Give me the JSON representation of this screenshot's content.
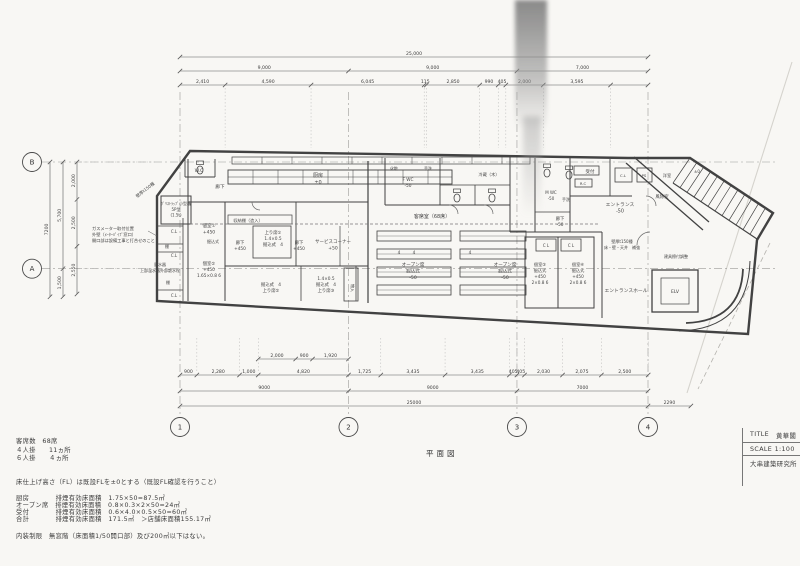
{
  "sheet": {
    "caption": "平面図"
  },
  "title_block": {
    "title_label": "TITLE",
    "title_value": "黄華閣",
    "scale": "SCALE 1:100",
    "firm": "大串建築研究所"
  },
  "notes": {
    "seats": "客席数　68席",
    "four_top": "４人掛　　11ヵ所",
    "six_top": "６人掛　　４ヵ所",
    "fl_note": "床仕上げ高さ（FL）は既設FLを±0とする（既設FL確認を行うこと）",
    "smoke_kitchen": "厨房　　　　排煙有効床面積　1.75×50=87.5㎡",
    "smoke_open": "オープン席　排煙有効床面積　0.8×0.3×2×50=24㎡",
    "smoke_reception": "受付　　　　排煙有効床面積　0.6×4.0×0.5×50=60㎡",
    "smoke_total": "合計　　　　排煙有効床面積　171.5㎡　＞店舗床面積155.17㎡",
    "interior_limit": "内装制限　無窓階（床面積1/50開口部）及び200㎡以下はない。"
  },
  "grid": {
    "bottom": [
      {
        "label": "1",
        "mm": 0
      },
      {
        "label": "2",
        "mm": 9000
      },
      {
        "label": "3",
        "mm": 18000
      },
      {
        "label": "4",
        "mm": 25000
      }
    ],
    "left": [
      {
        "label": "B",
        "mm": 0
      },
      {
        "label": "A",
        "mm": 5700
      }
    ]
  },
  "dimensions": {
    "top_rows": [
      {
        "y": 57,
        "full": true,
        "segs": [
          {
            "label": "25,000",
            "mm": 25000
          }
        ]
      },
      {
        "y": 71,
        "full": true,
        "segs": [
          {
            "label": "9,000",
            "mm": 9000
          },
          {
            "label": "9,000",
            "mm": 9000
          },
          {
            "label": "7,000",
            "mm": 7000
          }
        ]
      },
      {
        "y": 85,
        "full": true,
        "segs": [
          {
            "label": "2,410",
            "mm": 2410
          },
          {
            "label": "4,590",
            "mm": 4590
          },
          {
            "label": "6,045",
            "mm": 6045
          },
          {
            "label": "115",
            "mm": 115
          },
          {
            "label": "2,850",
            "mm": 2850
          },
          {
            "label": "990",
            "mm": 990
          },
          {
            "label": "405",
            "mm": 405
          },
          {
            "label": "2,000",
            "mm": 2000
          },
          {
            "label": "3,595",
            "mm": 3595
          }
        ]
      }
    ],
    "bottom_rows": [
      {
        "y": 359,
        "offset_mm": 4180,
        "segs": [
          {
            "label": "2,000",
            "mm": 2000
          },
          {
            "label": "900",
            "mm": 900
          },
          {
            "label": "1,920",
            "mm": 1920
          }
        ]
      },
      {
        "y": 375,
        "full": true,
        "segs": [
          {
            "label": "900",
            "mm": 900
          },
          {
            "label": "2,280",
            "mm": 2280
          },
          {
            "label": "1,000",
            "mm": 1000
          },
          {
            "label": "4,820",
            "mm": 4820
          },
          {
            "label": "1,725",
            "mm": 1725
          },
          {
            "label": "3,435",
            "mm": 3435
          },
          {
            "label": "3,435",
            "mm": 3435
          },
          {
            "label": "405",
            "mm": 405
          },
          {
            "label": "405",
            "mm": 405
          },
          {
            "label": "2,030",
            "mm": 2030
          },
          {
            "label": "2,075",
            "mm": 2075
          },
          {
            "label": "2,500",
            "mm": 2500
          }
        ]
      },
      {
        "y": 391,
        "full": true,
        "segs": [
          {
            "label": "9000",
            "mm": 9000
          },
          {
            "label": "9000",
            "mm": 9000
          },
          {
            "label": "7000",
            "mm": 7000
          }
        ]
      },
      {
        "y": 406,
        "full": true,
        "segs": [
          {
            "label": "25000",
            "mm": 25000
          }
        ],
        "ext": {
          "label": "2290",
          "mm": 2290
        }
      }
    ],
    "left_rows": [
      {
        "x": 77,
        "segs": [
          {
            "label": "2,000",
            "mm": 2000
          },
          {
            "label": "2,500",
            "mm": 2500
          },
          {
            "label": "2,550",
            "mm": 2550
          }
        ]
      },
      {
        "x": 63,
        "segs": [
          {
            "label": "5,700",
            "mm": 5700
          },
          {
            "label": "1,500",
            "mm": 1500
          }
        ]
      },
      {
        "x": 50,
        "segs": [
          {
            "label": "7200",
            "mm": 7200
          }
        ]
      }
    ]
  },
  "plan": {
    "labels": [
      {
        "id": "wc",
        "x": 199,
        "y": 172,
        "fs": 4.6,
        "lines": [
          "W.C"
        ]
      },
      {
        "id": "wall-note-tl",
        "x": 146,
        "y": 191,
        "fs": 4.2,
        "rot": -38,
        "lines": [
          "壁厚t150種"
        ]
      },
      {
        "id": "grease-trap",
        "x": 176,
        "y": 205,
        "fs": 4.0,
        "lines": [
          "ｸﾞﾘｽﾄﾗｯﾌﾟ小型槽",
          "5P型",
          "(1.5t)"
        ]
      },
      {
        "id": "corridor-top",
        "x": 220,
        "y": 188,
        "fs": 4.6,
        "lines": [
          "廊下"
        ]
      },
      {
        "id": "gas-note",
        "x": 92,
        "y": 230,
        "fs": 4.2,
        "anchor": "start",
        "lines": [
          "ガスメーター取付位置",
          "外壁（ﾒｰﾀｰﾊﾟｲﾌﾟ窓口）",
          "開口部は設備工事と打合せのこと"
        ]
      },
      {
        "id": "water-meter",
        "x": 160,
        "y": 266,
        "fs": 4.0,
        "lines": [
          "量水器",
          "上部温水器外部散水栓"
        ]
      },
      {
        "id": "closet-cl-1",
        "x": 174,
        "y": 233,
        "fs": 4.0,
        "lines": [
          "C.L"
        ]
      },
      {
        "id": "closet-tana-1",
        "x": 167,
        "y": 248,
        "fs": 4.0,
        "lines": [
          "棚"
        ]
      },
      {
        "id": "closet-cl-2",
        "x": 174,
        "y": 257,
        "fs": 4.0,
        "lines": [
          "C.L"
        ]
      },
      {
        "id": "closet-tana-2",
        "x": 168,
        "y": 284,
        "fs": 4.0,
        "lines": [
          "棚"
        ]
      },
      {
        "id": "closet-cl-3",
        "x": 174,
        "y": 297,
        "fs": 4.0,
        "lines": [
          "C.L"
        ]
      },
      {
        "id": "kitchen",
        "x": 318,
        "y": 177,
        "fs": 5.0,
        "lines": [
          "厨房",
          "±0"
        ]
      },
      {
        "id": "room-1",
        "x": 209,
        "y": 227,
        "fs": 4.5,
        "lines": [
          "個室①",
          "+450"
        ]
      },
      {
        "id": "room-1-note",
        "x": 213,
        "y": 243,
        "fs": 4.0,
        "lines": [
          "掘込式"
        ]
      },
      {
        "id": "room-2",
        "x": 209,
        "y": 265,
        "fs": 4.3,
        "lines": [
          "個室②",
          "+450",
          "1.65×0.8 6"
        ]
      },
      {
        "id": "storage-shelf",
        "x": 248,
        "y": 222,
        "fs": 4.2,
        "lines": [
          "収納棚（造入）"
        ]
      },
      {
        "id": "corridor-mid-1",
        "x": 240,
        "y": 244,
        "fs": 4.3,
        "lines": [
          "廊下",
          "+450"
        ]
      },
      {
        "id": "agari-1",
        "x": 273,
        "y": 234,
        "fs": 4.3,
        "lines": [
          "上り席①",
          "1.4×0.5",
          "掘込式　4"
        ]
      },
      {
        "id": "corridor-mid-2",
        "x": 299,
        "y": 244,
        "fs": 4.3,
        "lines": [
          "廊下",
          "+450"
        ]
      },
      {
        "id": "service-corner",
        "x": 333,
        "y": 243,
        "fs": 4.5,
        "lines": [
          "サービスコーナー",
          "+50"
        ]
      },
      {
        "id": "agari-2",
        "x": 271,
        "y": 286,
        "fs": 4.3,
        "lines": [
          "掘込式　4",
          "上り席②"
        ]
      },
      {
        "id": "agari-3",
        "x": 326,
        "y": 280,
        "fs": 4.3,
        "lines": [
          "1.4×0.5",
          "掘込式　4",
          "上り席③"
        ]
      },
      {
        "id": "mono-ire",
        "x": 351,
        "y": 288,
        "fs": 4.0,
        "rot": 90,
        "lines": [
          "物入"
        ]
      },
      {
        "id": "guest-seats",
        "x": 432,
        "y": 218,
        "fs": 5.0,
        "lines": [
          "客席室（68席）"
        ]
      },
      {
        "id": "kesho",
        "x": 394,
        "y": 170,
        "fs": 4.0,
        "lines": [
          "化粧"
        ]
      },
      {
        "id": "tearai-1",
        "x": 428,
        "y": 170,
        "fs": 4.0,
        "lines": [
          "手洗"
        ]
      },
      {
        "id": "fwc",
        "x": 408,
        "y": 181,
        "fs": 4.3,
        "lines": [
          "F WC",
          "-50"
        ]
      },
      {
        "id": "reizo",
        "x": 489,
        "y": 176,
        "fs": 4.2,
        "lines": [
          "冷蔵（木）"
        ]
      },
      {
        "id": "mwc",
        "x": 551,
        "y": 194,
        "fs": 4.0,
        "lines": [
          "M WC",
          "-50"
        ]
      },
      {
        "id": "tearai-2",
        "x": 566,
        "y": 201,
        "fs": 4.0,
        "lines": [
          "手洗"
        ]
      },
      {
        "id": "corridor-right",
        "x": 560,
        "y": 220,
        "fs": 4.3,
        "lines": [
          "廊下",
          "-50"
        ]
      },
      {
        "id": "cl-4",
        "x": 546,
        "y": 247,
        "fs": 4.0,
        "lines": [
          "C L"
        ]
      },
      {
        "id": "cl-5",
        "x": 571,
        "y": 247,
        "fs": 4.0,
        "lines": [
          "C L"
        ]
      },
      {
        "id": "room-3",
        "x": 540,
        "y": 266,
        "fs": 4.2,
        "lines": [
          "個室③",
          "掘込式",
          "+450",
          "2×0.8 6"
        ]
      },
      {
        "id": "room-4",
        "x": 578,
        "y": 266,
        "fs": 4.2,
        "lines": [
          "個室④",
          "掘込式",
          "+450",
          "2×0.8 6"
        ]
      },
      {
        "id": "open-1",
        "x": 413,
        "y": 266,
        "fs": 4.6,
        "lines": [
          "オープン席",
          "掘込式",
          "-50"
        ]
      },
      {
        "id": "open-2",
        "x": 505,
        "y": 266,
        "fs": 4.6,
        "lines": [
          "オープン席",
          "掘込式",
          "-50"
        ]
      },
      {
        "id": "seat-count-1",
        "x": 399,
        "y": 254,
        "fs": 4.2,
        "lines": [
          "4"
        ]
      },
      {
        "id": "seat-count-2",
        "x": 414,
        "y": 254,
        "fs": 4.2,
        "lines": [
          "4"
        ]
      },
      {
        "id": "seat-count-3",
        "x": 470,
        "y": 254,
        "fs": 4.2,
        "lines": [
          "4"
        ]
      },
      {
        "id": "entrance",
        "x": 620,
        "y": 206,
        "fs": 4.8,
        "lines": [
          "エントランス",
          "-50"
        ]
      },
      {
        "id": "reception",
        "x": 590,
        "y": 173,
        "fs": 4.5,
        "lines": [
          "受付"
        ]
      },
      {
        "id": "rc",
        "x": 583,
        "y": 185,
        "fs": 3.8,
        "lines": [
          "R.C"
        ]
      },
      {
        "id": "cl-6",
        "x": 623,
        "y": 177,
        "fs": 3.8,
        "lines": [
          "C.L"
        ]
      },
      {
        "id": "ps",
        "x": 644,
        "y": 177,
        "fs": 3.8,
        "lines": [
          "PS"
        ]
      },
      {
        "id": "yoshitsu",
        "x": 667,
        "y": 177,
        "fs": 4.2,
        "lines": [
          "洋室"
        ]
      },
      {
        "id": "plus-minus-zero",
        "x": 697,
        "y": 173,
        "fs": 4.0,
        "lines": [
          "±0"
        ]
      },
      {
        "id": "fujo",
        "x": 662,
        "y": 198,
        "fs": 4.4,
        "lines": [
          "風除室"
        ]
      },
      {
        "id": "wall-note-r",
        "x": 622,
        "y": 243,
        "fs": 4.0,
        "lines": [
          "壁厚t150種",
          "床・壁・天井　補強"
        ]
      },
      {
        "id": "tategu-note",
        "x": 676,
        "y": 258,
        "fs": 4.0,
        "lines": [
          "建具擦付調整"
        ]
      },
      {
        "id": "entrance-hall",
        "x": 626,
        "y": 292,
        "fs": 4.8,
        "lines": [
          "エントランスホール"
        ]
      },
      {
        "id": "elv",
        "x": 675,
        "y": 293,
        "fs": 4.6,
        "lines": [
          "ELV"
        ]
      }
    ]
  },
  "colors": {
    "ink": "#424242",
    "thin": "#5a5a5a",
    "light": "#9a9a98",
    "dim_text": "#444444"
  }
}
